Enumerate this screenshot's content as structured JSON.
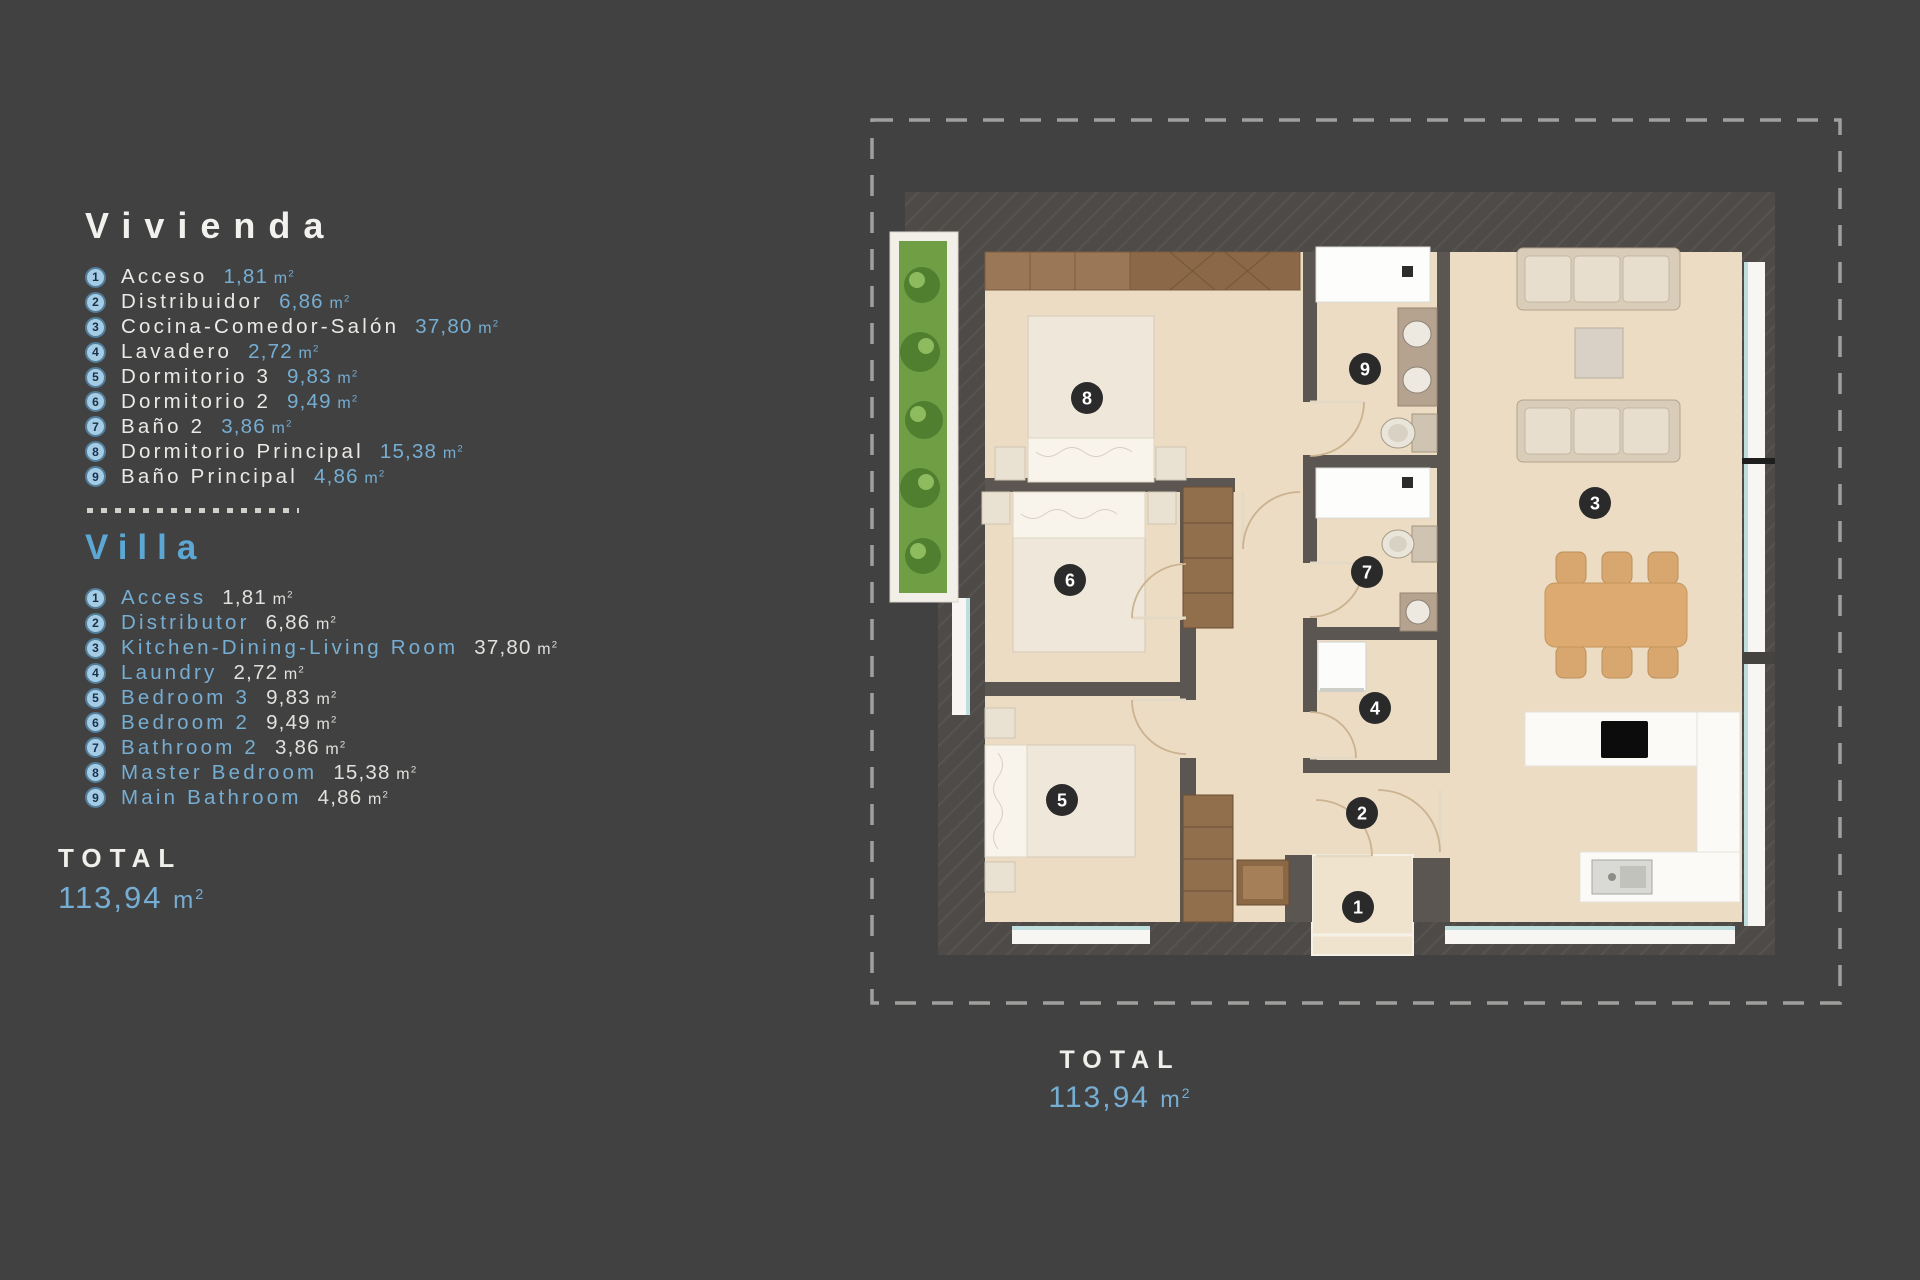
{
  "colors": {
    "background": "#414141",
    "accent_blue": "#76aed3",
    "title_blue": "#5ca7d3",
    "text_white": "#f0efeb",
    "floor_beige": "#ecdcc3",
    "wall_dark": "#4d4a47",
    "planter_green": "#6f9e45",
    "marker_black": "#1c1c1e"
  },
  "legend": {
    "unit_base": "m",
    "unit_sup": "2",
    "vivienda": {
      "title": "Vivienda",
      "items": [
        {
          "n": "1",
          "name": "Acceso",
          "area": "1,81"
        },
        {
          "n": "2",
          "name": "Distribuidor",
          "area": "6,86"
        },
        {
          "n": "3",
          "name": "Cocina-Comedor-Salón",
          "area": "37,80"
        },
        {
          "n": "4",
          "name": "Lavadero",
          "area": "2,72"
        },
        {
          "n": "5",
          "name": "Dormitorio 3",
          "area": "9,83"
        },
        {
          "n": "6",
          "name": "Dormitorio 2",
          "area": "9,49"
        },
        {
          "n": "7",
          "name": "Baño 2",
          "area": "3,86"
        },
        {
          "n": "8",
          "name": "Dormitorio Principal",
          "area": "15,38"
        },
        {
          "n": "9",
          "name": "Baño Principal",
          "area": "4,86"
        }
      ]
    },
    "villa": {
      "title": "Villa",
      "items": [
        {
          "n": "1",
          "name": "Access",
          "area": "1,81"
        },
        {
          "n": "2",
          "name": "Distributor",
          "area": "6,86"
        },
        {
          "n": "3",
          "name": "Kitchen-Dining-Living Room",
          "area": "37,80"
        },
        {
          "n": "4",
          "name": "Laundry",
          "area": "2,72"
        },
        {
          "n": "5",
          "name": "Bedroom 3",
          "area": "9,83"
        },
        {
          "n": "6",
          "name": "Bedroom 2",
          "area": "9,49"
        },
        {
          "n": "7",
          "name": "Bathroom 2",
          "area": "3,86"
        },
        {
          "n": "8",
          "name": "Master Bedroom",
          "area": "15,38"
        },
        {
          "n": "9",
          "name": "Main Bathroom",
          "area": "4,86"
        }
      ]
    },
    "total_label": "TOTAL",
    "total_value": "113,94"
  },
  "plan": {
    "total_label": "TOTAL",
    "total_value": "113,94",
    "markers": [
      {
        "n": "1",
        "x": 1358,
        "y": 907
      },
      {
        "n": "2",
        "x": 1362,
        "y": 813
      },
      {
        "n": "3",
        "x": 1595,
        "y": 503
      },
      {
        "n": "4",
        "x": 1375,
        "y": 708
      },
      {
        "n": "5",
        "x": 1062,
        "y": 800
      },
      {
        "n": "6",
        "x": 1070,
        "y": 580
      },
      {
        "n": "7",
        "x": 1367,
        "y": 572
      },
      {
        "n": "8",
        "x": 1087,
        "y": 398
      },
      {
        "n": "9",
        "x": 1365,
        "y": 369
      }
    ]
  }
}
